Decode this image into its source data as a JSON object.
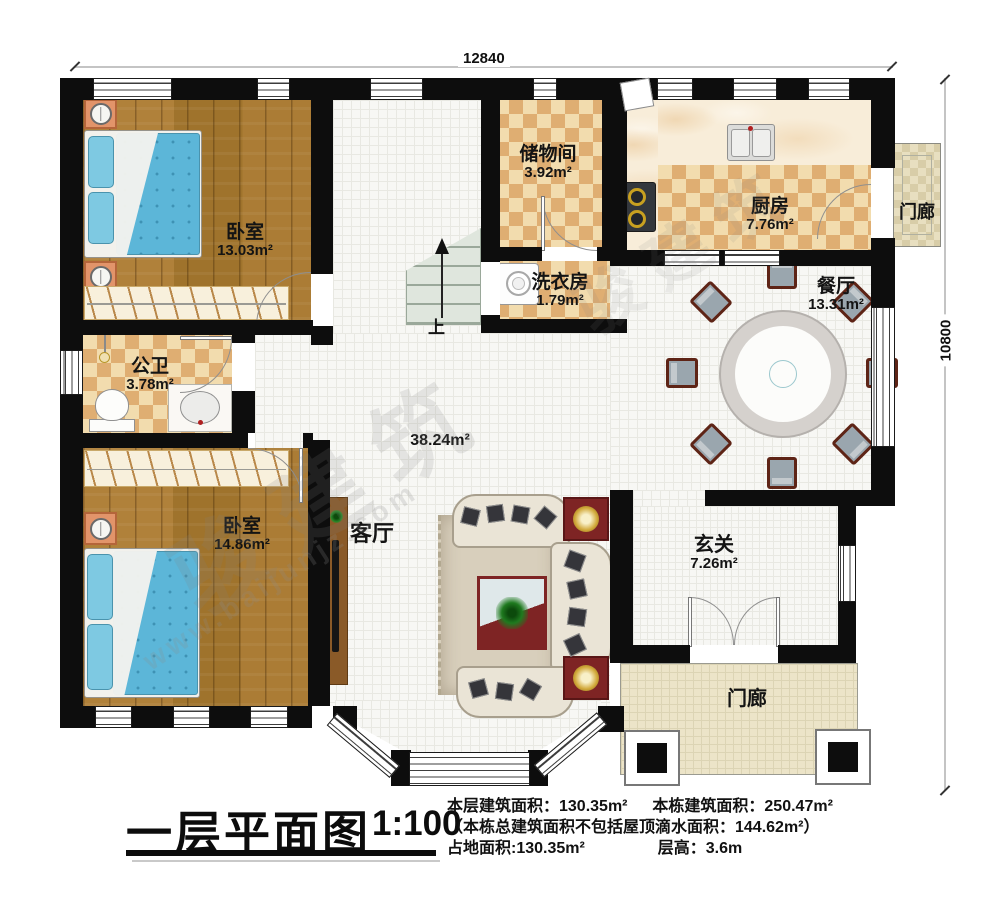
{
  "dims": {
    "width_top": "12840",
    "height_right": "10800"
  },
  "rooms": {
    "bedroom1": {
      "name": "卧室",
      "area": "13.03m²"
    },
    "storage": {
      "name": "储物间",
      "area": "3.92m²"
    },
    "laundry": {
      "name": "洗衣房",
      "area": "1.79m²"
    },
    "kitchen": {
      "name": "厨房",
      "area": "7.76m²"
    },
    "porch_right": {
      "name": "门廊"
    },
    "dining": {
      "name": "餐厅",
      "area": "13.31m²"
    },
    "bathroom": {
      "name": "公卫",
      "area": "3.78m²"
    },
    "bedroom2": {
      "name": "卧室",
      "area": "14.86m²"
    },
    "living": {
      "name": "客厅",
      "area": "38.24m²"
    },
    "entry": {
      "name": "玄关",
      "area": "7.26m²"
    },
    "porch_bottom": {
      "name": "门廊"
    }
  },
  "stairs": {
    "up": "上"
  },
  "watermark": {
    "cn": "骏建筑",
    "url": "www.baijunjz.com"
  },
  "footer": {
    "title": "一层平面图",
    "scale": "1:100",
    "stat1a": "本层建筑面积：130.35m²",
    "stat1b": "本栋建筑面积：250.47m²",
    "stat2": "（本栋总建筑面积不包括屋顶滴水面积：144.62m²）",
    "stat3a": "占地面积:130.35m²",
    "stat3b": "层高：3.6m"
  },
  "colors": {
    "wall": "#0d0d0d",
    "wood": "#a87a33",
    "checker_dark": "#dfae72",
    "accent_red": "#7e2424",
    "bed_blue": "#5cb6d8"
  }
}
